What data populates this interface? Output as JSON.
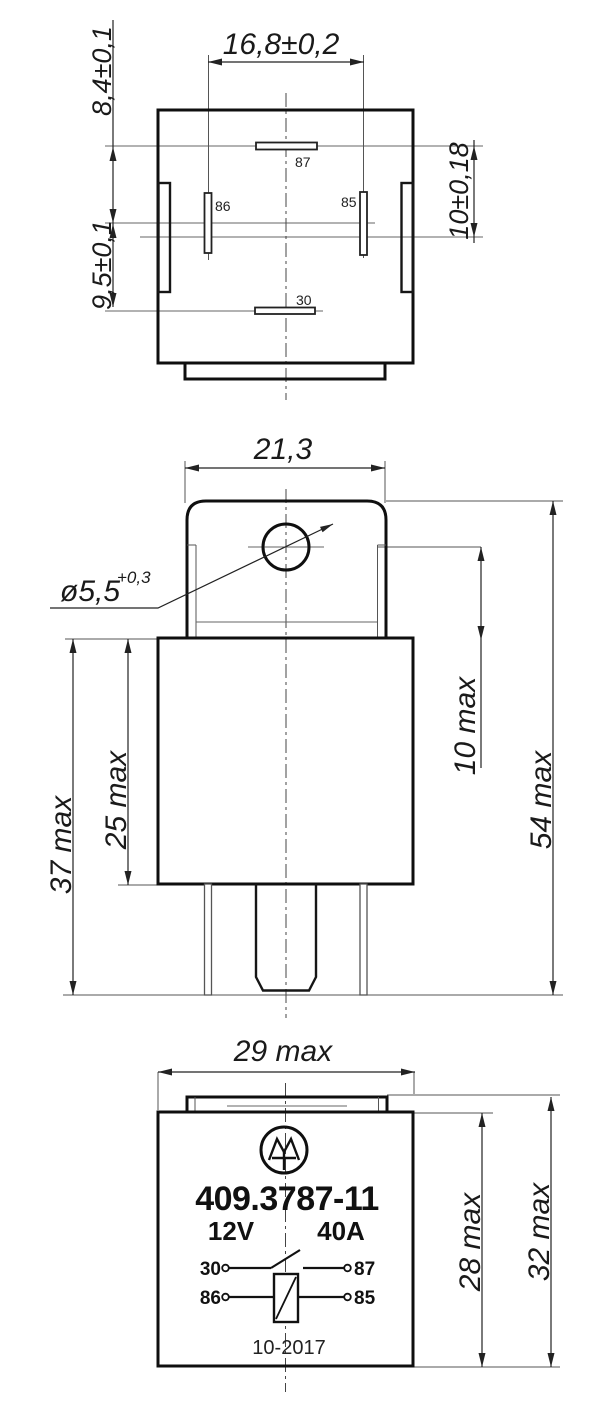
{
  "views": {
    "top_view": {
      "dims": {
        "pin_span": "16,8±0,2",
        "top_to_87": "8,4±0,1",
        "axis_to_30": "9,5±0,1",
        "right_span": "10±0,18"
      },
      "pins": {
        "p87": "87",
        "p86": "86",
        "p85": "85",
        "p30": "30"
      }
    },
    "side_view": {
      "dims": {
        "bracket_width": "21,3",
        "hole_dia": "ø5,5",
        "hole_tol": "+0,3",
        "hole_to_body": "10 max",
        "total_height": "54 max",
        "body_with_pins": "37 max",
        "body_height": "25 max"
      }
    },
    "front_view": {
      "dims": {
        "width": "29 max",
        "body_height": "28 max",
        "height_with_tab": "32 max"
      },
      "marking": {
        "part_number": "409.3787-11",
        "voltage": "12V",
        "current": "40A",
        "date_code": "10-2017"
      },
      "schematic": {
        "p30": "30",
        "p87": "87",
        "p86": "86",
        "p85": "85"
      }
    }
  }
}
